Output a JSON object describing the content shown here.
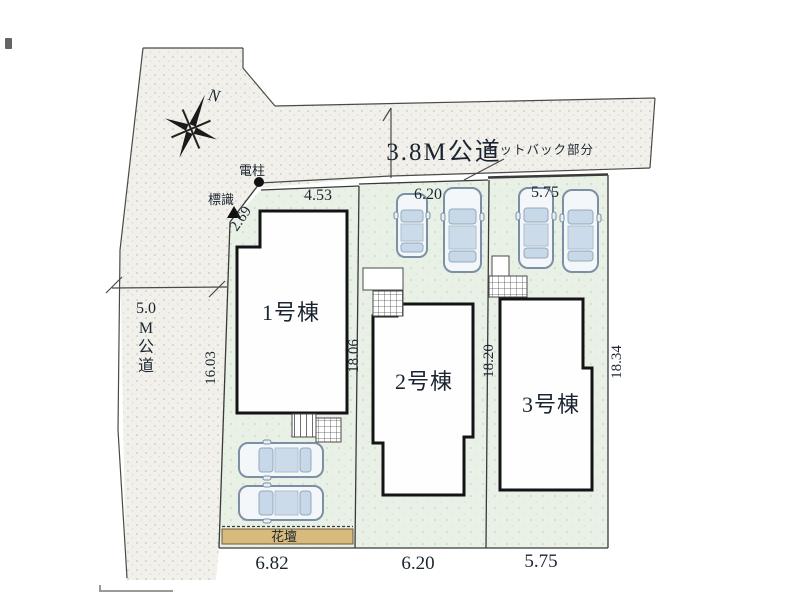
{
  "compass": {
    "north_label": "N"
  },
  "roads": {
    "top_road_label": "3.8M公道",
    "setback_label": "セットバック部分",
    "left_road_label_chars": [
      "5.0",
      "M",
      "公",
      "道"
    ]
  },
  "landmarks": {
    "utility_pole_label": "電柱",
    "sign_label": "標識",
    "flower_bed_label": "花壇"
  },
  "lots": [
    {
      "building_label": "1号棟",
      "top_dim": "4.53",
      "bottom_dim": "6.82",
      "left_dim": "16.03",
      "right_dim": "18.06",
      "corner_dim": "2.69"
    },
    {
      "building_label": "2号棟",
      "top_dim": "6.20",
      "bottom_dim": "6.20",
      "right_dim": "18.20"
    },
    {
      "building_label": "3号棟",
      "top_dim": "5.75",
      "bottom_dim": "5.75",
      "right_dim": "18.34"
    }
  ],
  "colors": {
    "road_fill": "#f1f0ea",
    "lot_fill": "#e9f1e7",
    "flower_bed_fill": "#d9ba7d",
    "boundary_line": "#3a3a3a",
    "building_outline": "#141414",
    "car_window": "#c7d8e8",
    "text": "#1b2531"
  }
}
